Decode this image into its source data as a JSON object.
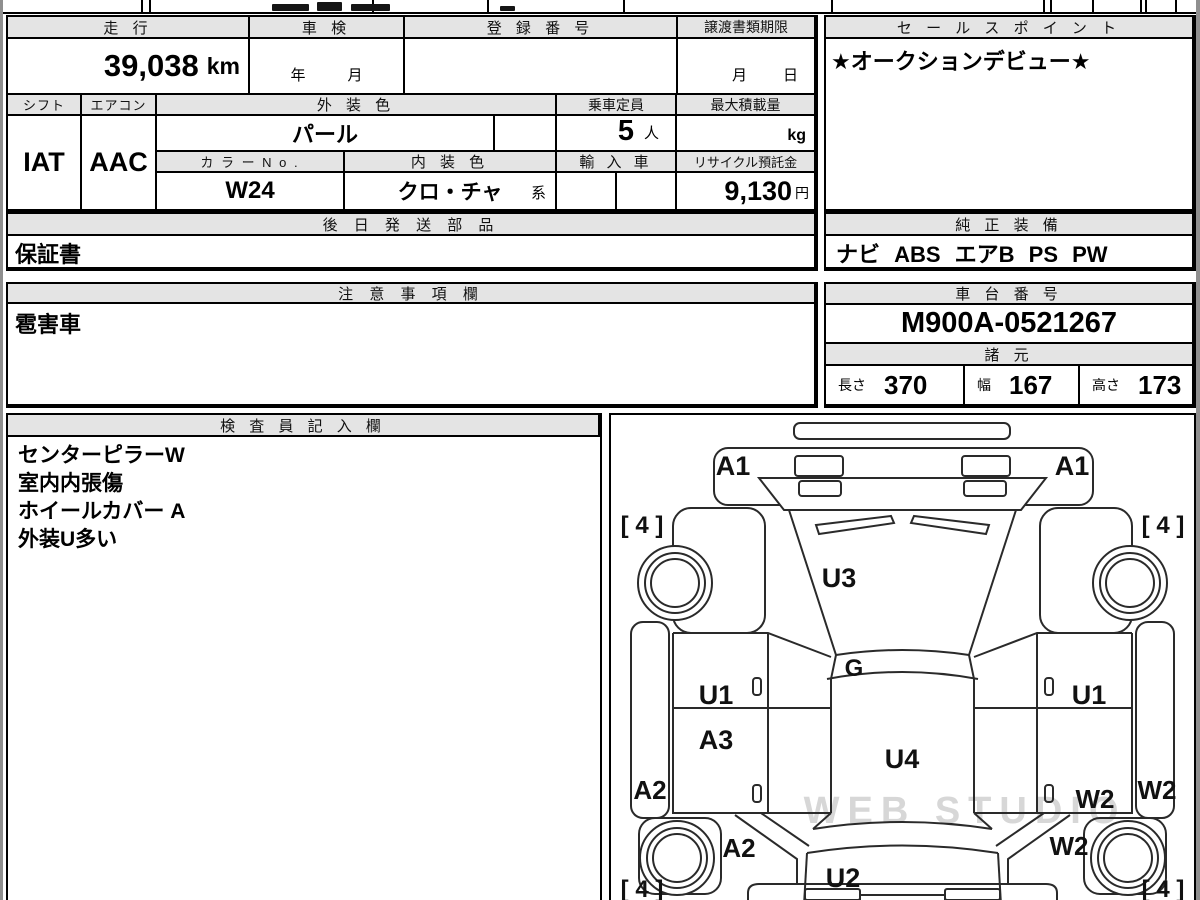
{
  "sheet": {
    "mileage_header": "走 行",
    "mileage_value": "39,038",
    "mileage_unit": "km",
    "shaken_header": "車 検",
    "shaken_year": "年",
    "shaken_month": "月",
    "registration_header": "登 録 番 号",
    "transfer_header": "譲渡書類期限",
    "transfer_month": "月",
    "transfer_day": "日",
    "shift_header": "シフト",
    "shift_value": "IAT",
    "aircon_header": "エアコン",
    "aircon_value": "AAC",
    "exterior_color_header": "外 装 色",
    "exterior_color": "パール",
    "capacity_header": "乗車定員",
    "capacity_value": "5",
    "capacity_unit": "人",
    "max_load_header": "最大積載量",
    "max_load_unit": "kg",
    "color_no_header": "カ ラ ー N o .",
    "color_no": "W24",
    "interior_color_header": "内 装 色",
    "interior_color": "クロ・チャ",
    "interior_color_suffix": "系",
    "import_header": "輸 入 車",
    "recycle_header": "リサイクル預託金",
    "recycle_fee": "9,130",
    "recycle_unit": "円",
    "later_parts_header": "後 日 発 送 部 品",
    "later_parts_value": "保証書",
    "sales_point_header": "セ ー ル ス ポ イ ン ト",
    "sales_point_value": "★オークションデビュー★",
    "equipment_header": "純 正 装 備",
    "equipment_value": "ナビ ABS エアB PS PW",
    "notes_header": "注 意 事 項 欄",
    "notes_value": "雹害車",
    "chassis_header": "車 台 番 号",
    "chassis_number": "M900A-0521267",
    "specs_header": "諸 元",
    "length_label": "長さ",
    "length_value": "370",
    "width_label": "幅",
    "width_value": "167",
    "height_label": "高さ",
    "height_value": "173",
    "inspector_header": "検 査 員 記 入 欄",
    "inspector_lines": [
      "センターピラーW",
      "室内内張傷",
      "ホイールカバー A",
      "外装U多い"
    ]
  },
  "diagram": {
    "watermark": "WEB STUDIO",
    "labels": {
      "front_bumper_left": "A1",
      "front_bumper_right": "A1",
      "tire_front_left": "[ 4 ]",
      "tire_front_right": "[ 4 ]",
      "windshield": "U3",
      "cowl": "G",
      "door_front_left": "U1",
      "door_front_right": "U1",
      "door_rear_left": "A3",
      "roof": "U4",
      "sill_left": "A2",
      "sill_right": "W2",
      "door_rear_right": "W2",
      "quarter_left": "A2",
      "quarter_right": "W2",
      "tailgate": "U2",
      "tire_rear_left": "[ 4 ]",
      "tire_rear_right": "[ 4 ]"
    }
  }
}
